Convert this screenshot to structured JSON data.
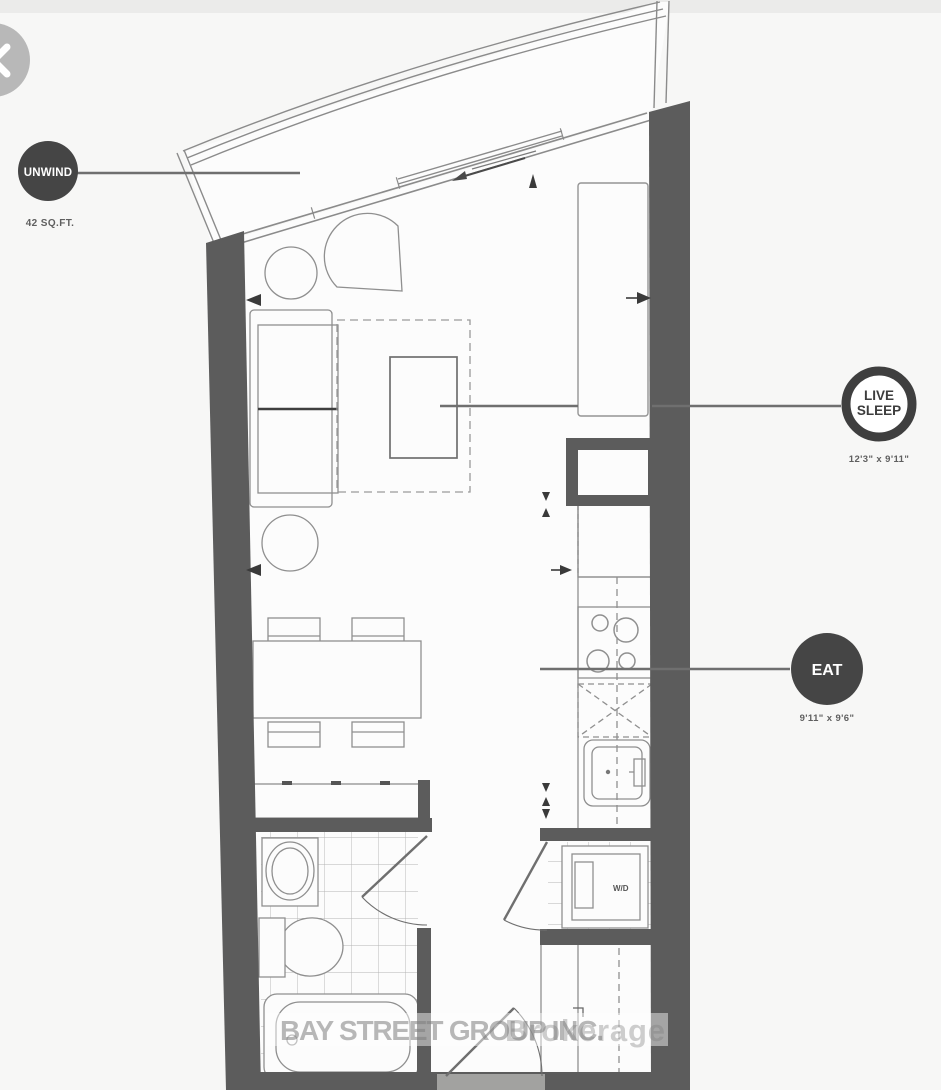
{
  "viewer": {
    "close_tooltip": "close"
  },
  "badges": {
    "unwind": {
      "label": "UNWIND",
      "area": "42 SQ.FT."
    },
    "live_sleep": {
      "line1": "LIVE",
      "line2": "SLEEP",
      "dimensions": "12'3\" x 9'11\""
    },
    "eat": {
      "label": "EAT",
      "dimensions": "9'11\" x 9'6\""
    }
  },
  "labels": {
    "washer_dryer": "W/D"
  },
  "watermark": {
    "text": "BAY STREET GROUP INC.",
    "suffix": "Brokerage"
  },
  "colors": {
    "wall": "#5c5c5c",
    "badge_fill": "#454545",
    "leader_line": "#6f6f6f",
    "floor": "#fcfcfc",
    "background": "#f7f7f6",
    "watermark": "#8f8f8f",
    "close_button": "#b8b8b8"
  }
}
